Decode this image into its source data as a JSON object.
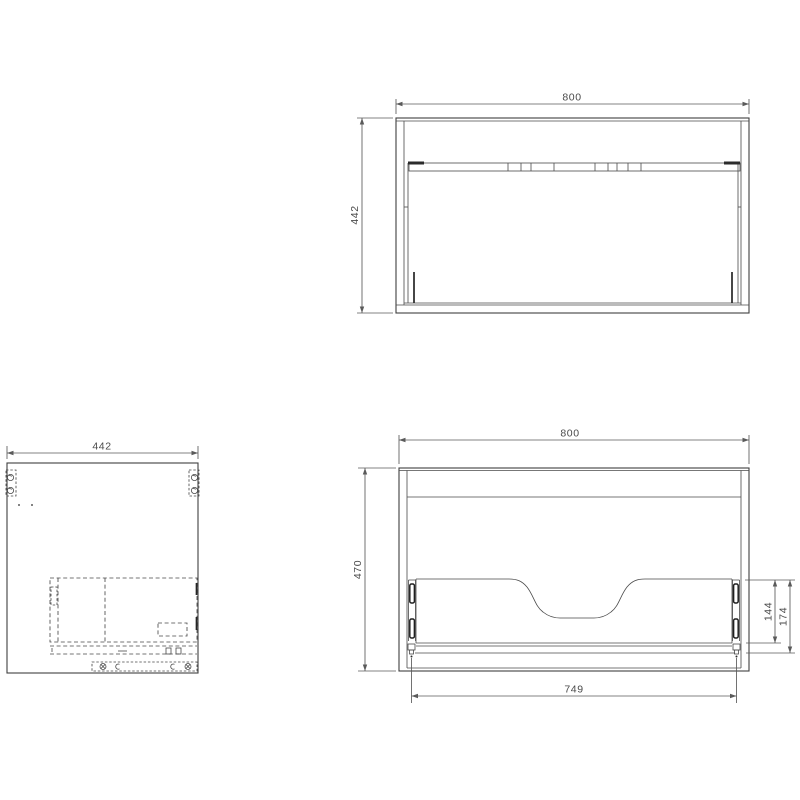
{
  "drawing": {
    "background_color": "#ffffff",
    "line_color": "#3f3f3f",
    "dimension_color": "#5a5a5a",
    "views": {
      "front": {
        "dim_width": "800",
        "dim_height": "442"
      },
      "side": {
        "dim_depth": "442"
      },
      "back": {
        "dim_width": "800",
        "dim_height": "470",
        "dim_inner_width": "749",
        "dim_cutout": "144",
        "dim_back": "174"
      }
    }
  }
}
